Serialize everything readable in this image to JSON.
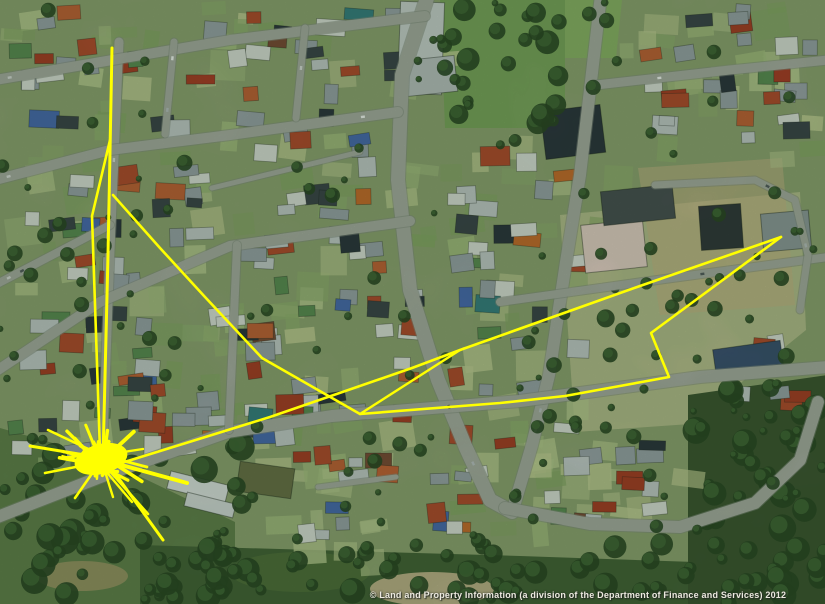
{
  "map": {
    "copyright": "© Land and Property Information (a division of the Department of Finance and Services) 2012",
    "canvas": {
      "width": 825,
      "height": 604
    },
    "colors": {
      "track": "#ffff00",
      "ground": "#8fa073",
      "road": "#a7aaa2",
      "road_casing": "#858a82"
    },
    "regions": [
      {
        "type": "poly",
        "pts": [
          [
            440,
            0
          ],
          [
            565,
            0
          ],
          [
            565,
            128
          ],
          [
            445,
            128
          ]
        ],
        "fill": "#7ba25e",
        "op": 0.95
      },
      {
        "type": "poly",
        "pts": [
          [
            565,
            0
          ],
          [
            622,
            0
          ],
          [
            616,
            58
          ],
          [
            565,
            58
          ]
        ],
        "fill": "#8cb168",
        "op": 0.95
      },
      {
        "type": "poly",
        "pts": [
          [
            560,
            215
          ],
          [
            800,
            192
          ],
          [
            806,
            330
          ],
          [
            690,
            424
          ],
          [
            575,
            432
          ]
        ],
        "fill": "#b7bc8e",
        "op": 0.95
      },
      {
        "type": "poly",
        "pts": [
          [
            638,
            168
          ],
          [
            782,
            158
          ],
          [
            795,
            305
          ],
          [
            660,
            315
          ]
        ],
        "fill": "#c6b086",
        "op": 0.55
      },
      {
        "type": "poly",
        "pts": [
          [
            0,
            428
          ],
          [
            95,
            455
          ],
          [
            235,
            522
          ],
          [
            235,
            604
          ],
          [
            0,
            604
          ]
        ],
        "fill": "#647f4e",
        "op": 1
      },
      {
        "type": "poly",
        "pts": [
          [
            140,
            545
          ],
          [
            520,
            556
          ],
          [
            695,
            562
          ],
          [
            695,
            604
          ],
          [
            140,
            604
          ]
        ],
        "fill": "#46603a",
        "op": 1
      },
      {
        "type": "poly",
        "pts": [
          [
            688,
            395
          ],
          [
            828,
            375
          ],
          [
            828,
            604
          ],
          [
            688,
            604
          ]
        ],
        "fill": "#3e5433",
        "op": 1
      },
      {
        "type": "ellipse",
        "cx": 432,
        "cy": 589,
        "rx": 62,
        "ry": 17,
        "fill": "#c9b894",
        "op": 0.9
      },
      {
        "type": "ellipse",
        "cx": 82,
        "cy": 576,
        "rx": 46,
        "ry": 15,
        "fill": "#b79e74",
        "op": 0.6
      },
      {
        "type": "ellipse",
        "cx": 300,
        "cy": 572,
        "rx": 70,
        "ry": 20,
        "fill": "#55703f",
        "op": 0.8
      }
    ],
    "yard_zones": [
      {
        "x": 0,
        "y": 0,
        "w": 430,
        "h": 470,
        "n": 90
      },
      {
        "x": 440,
        "y": 120,
        "w": 165,
        "h": 350,
        "n": 28
      },
      {
        "x": 610,
        "y": 0,
        "w": 215,
        "h": 155,
        "n": 22
      },
      {
        "x": 235,
        "y": 430,
        "w": 290,
        "h": 120,
        "n": 18
      },
      {
        "x": 520,
        "y": 430,
        "w": 170,
        "h": 110,
        "n": 14
      }
    ],
    "yard_palette": [
      "#a6bb82",
      "#b9c792",
      "#93ad72",
      "#c3cb97",
      "#88a468"
    ],
    "house_zones": [
      {
        "x": 4,
        "y": 4,
        "w": 424,
        "h": 462,
        "n": 150
      },
      {
        "x": 444,
        "y": 118,
        "w": 152,
        "h": 348,
        "n": 30
      },
      {
        "x": 612,
        "y": 4,
        "w": 210,
        "h": 148,
        "n": 26
      },
      {
        "x": 238,
        "y": 428,
        "w": 282,
        "h": 122,
        "n": 20
      },
      {
        "x": 522,
        "y": 430,
        "w": 165,
        "h": 108,
        "n": 14
      },
      {
        "x": 700,
        "y": 330,
        "w": 120,
        "h": 90,
        "n": 6
      }
    ],
    "house_palette": [
      "#9aa1a8",
      "#9aa1a8",
      "#9aa1a8",
      "#9aa1a8",
      "#9aa1a8",
      "#d9dbd6",
      "#d9dbd6",
      "#d9dbd6",
      "#d9dbd6",
      "#c2c7c9",
      "#c2c7c9",
      "#c2c7c9",
      "#a73b28",
      "#a73b28",
      "#b14a30",
      "#b14a30",
      "#c06038",
      "#3d434c",
      "#3d434c",
      "#2e3440",
      "#5d8a56",
      "#5d8a56",
      "#3a7d82",
      "#4a69b0",
      "#7a4a38",
      "#c56a2e"
    ],
    "landmarks": [
      {
        "x": 399,
        "y": 2,
        "w": 44,
        "h": 92,
        "fill": "#c9cdcd",
        "rot": 2
      },
      {
        "x": 404,
        "y": 58,
        "w": 52,
        "h": 36,
        "fill": "#b9bec0",
        "rot": -6
      },
      {
        "x": 543,
        "y": 108,
        "w": 60,
        "h": 48,
        "fill": "#2e3440",
        "rot": -7
      },
      {
        "x": 583,
        "y": 222,
        "w": 62,
        "h": 48,
        "fill": "#e3cdc6",
        "rot": -6
      },
      {
        "x": 602,
        "y": 188,
        "w": 72,
        "h": 34,
        "fill": "#4a4e54",
        "rot": -6
      },
      {
        "x": 700,
        "y": 205,
        "w": 42,
        "h": 44,
        "fill": "#33373d",
        "rot": -4
      },
      {
        "x": 762,
        "y": 212,
        "w": 48,
        "h": 38,
        "fill": "#8e979c",
        "rot": -5
      },
      {
        "x": 714,
        "y": 345,
        "w": 68,
        "h": 24,
        "fill": "#3c4f72",
        "rot": -8
      },
      {
        "x": 168,
        "y": 478,
        "w": 60,
        "h": 18,
        "fill": "#dcdfdf",
        "rot": 14
      },
      {
        "x": 185,
        "y": 498,
        "w": 50,
        "h": 14,
        "fill": "#d2d6d6",
        "rot": 14
      },
      {
        "x": 238,
        "y": 465,
        "w": 55,
        "h": 30,
        "fill": "#6b6f4a",
        "rot": 8
      }
    ],
    "tree_zones": [
      {
        "x": 0,
        "y": 438,
        "w": 245,
        "h": 164,
        "n": 42,
        "rMin": 5,
        "rMax": 14
      },
      {
        "x": 140,
        "y": 540,
        "w": 560,
        "h": 62,
        "n": 55,
        "rMin": 5,
        "rMax": 13
      },
      {
        "x": 682,
        "y": 385,
        "w": 143,
        "h": 219,
        "n": 48,
        "rMin": 5,
        "rMax": 14
      },
      {
        "x": 444,
        "y": 0,
        "w": 118,
        "h": 132,
        "n": 24,
        "rMin": 5,
        "rMax": 12
      },
      {
        "x": 560,
        "y": 200,
        "w": 265,
        "h": 228,
        "n": 16,
        "rMin": 4,
        "rMax": 9
      },
      {
        "x": 0,
        "y": 0,
        "w": 825,
        "h": 545,
        "n": 130,
        "rMin": 3,
        "rMax": 8
      }
    ],
    "tree_colors": [
      "#2c4527",
      "#44663a"
    ],
    "roads": [
      {
        "w": 14,
        "pts": [
          [
            428,
            -5
          ],
          [
            402,
            75
          ],
          [
            398,
            180
          ],
          [
            410,
            290
          ],
          [
            438,
            380
          ],
          [
            466,
            448
          ],
          [
            490,
            500
          ],
          [
            512,
            512
          ]
        ]
      },
      {
        "w": 12,
        "pts": [
          [
            601,
            -5
          ],
          [
            590,
            90
          ],
          [
            580,
            175
          ],
          [
            566,
            262
          ],
          [
            549,
            375
          ],
          [
            532,
            445
          ],
          [
            514,
            506
          ]
        ]
      },
      {
        "w": 12,
        "pts": [
          [
            505,
            508
          ],
          [
            590,
            524
          ],
          [
            680,
            527
          ],
          [
            755,
            503
          ],
          [
            800,
            460
          ],
          [
            818,
            402
          ]
        ]
      },
      {
        "w": 12,
        "pts": [
          [
            -5,
            518
          ],
          [
            108,
            474
          ],
          [
            228,
            432
          ],
          [
            332,
            416
          ],
          [
            520,
            401
          ],
          [
            700,
            377
          ],
          [
            828,
            367
          ]
        ]
      },
      {
        "w": 9,
        "pts": [
          [
            119,
            42
          ],
          [
            110,
            250
          ],
          [
            102,
            466
          ]
        ]
      },
      {
        "w": 10,
        "pts": [
          [
            -5,
            80
          ],
          [
            230,
            40
          ],
          [
            425,
            16
          ]
        ]
      },
      {
        "w": 10,
        "pts": [
          [
            -5,
            180
          ],
          [
            110,
            150
          ],
          [
            230,
            135
          ],
          [
            398,
            112
          ]
        ]
      },
      {
        "w": 8,
        "pts": [
          [
            -5,
            285
          ],
          [
            110,
            225
          ]
        ]
      },
      {
        "w": 10,
        "pts": [
          [
            -5,
            372
          ],
          [
            100,
            302
          ],
          [
            230,
            246
          ],
          [
            410,
            221
          ]
        ]
      },
      {
        "w": 8,
        "pts": [
          [
            500,
            302
          ],
          [
            650,
            281
          ],
          [
            828,
            257
          ]
        ]
      },
      {
        "w": 9,
        "pts": [
          [
            596,
            85
          ],
          [
            730,
            70
          ],
          [
            828,
            60
          ]
        ]
      },
      {
        "w": 7,
        "pts": [
          [
            174,
            42
          ],
          [
            165,
            134
          ]
        ]
      },
      {
        "w": 7,
        "pts": [
          [
            305,
            28
          ],
          [
            296,
            118
          ]
        ]
      },
      {
        "w": 8,
        "pts": [
          [
            237,
            245
          ],
          [
            229,
            430
          ]
        ]
      },
      {
        "w": 7,
        "pts": [
          [
            655,
            185
          ],
          [
            755,
            180
          ],
          [
            795,
            200
          ],
          [
            808,
            255
          ],
          [
            800,
            310
          ]
        ]
      },
      {
        "w": 5,
        "pts": [
          [
            212,
            188
          ],
          [
            360,
            152
          ]
        ]
      },
      {
        "w": 5,
        "pts": [
          [
            318,
            487
          ],
          [
            396,
            477
          ]
        ]
      }
    ],
    "tracks": [
      {
        "w": 3.0,
        "pts": [
          [
            112,
            48
          ],
          [
            108,
            255
          ],
          [
            103,
            458
          ]
        ]
      },
      {
        "w": 2.6,
        "pts": [
          [
            110,
            140
          ],
          [
            92,
            216
          ],
          [
            100,
            452
          ]
        ]
      },
      {
        "w": 2.6,
        "pts": [
          [
            113,
            195
          ],
          [
            160,
            248
          ],
          [
            205,
            297
          ],
          [
            262,
            358
          ],
          [
            360,
            414
          ],
          [
            500,
            403
          ],
          [
            565,
            396
          ],
          [
            669,
            377
          ],
          [
            651,
            333
          ],
          [
            781,
            237
          ]
        ]
      },
      {
        "w": 2.6,
        "pts": [
          [
            781,
            237
          ],
          [
            640,
            286
          ],
          [
            460,
            350
          ],
          [
            412,
            368
          ],
          [
            270,
            417
          ],
          [
            118,
            464
          ]
        ]
      },
      {
        "w": 2.4,
        "pts": [
          [
            460,
            350
          ],
          [
            360,
            414
          ]
        ]
      },
      {
        "w": 3.0,
        "pts": [
          [
            104,
            458
          ],
          [
            163,
            540
          ]
        ]
      },
      {
        "w": 2.6,
        "pts": [
          [
            100,
            460
          ],
          [
            148,
            514
          ]
        ]
      },
      {
        "w": 2.4,
        "pts": [
          [
            98,
            462
          ],
          [
            132,
            502
          ]
        ]
      },
      {
        "w": 4.0,
        "pts": [
          [
            103,
            460
          ],
          [
            187,
            483
          ]
        ]
      },
      {
        "w": 3.0,
        "pts": [
          [
            103,
            458
          ],
          [
            30,
            446
          ]
        ]
      },
      {
        "w": 2.6,
        "pts": [
          [
            101,
            462
          ],
          [
            45,
            473
          ]
        ]
      },
      {
        "w": 2.6,
        "pts": [
          [
            103,
            456
          ],
          [
            48,
            430
          ]
        ]
      },
      {
        "w": 2.6,
        "pts": [
          [
            100,
            462
          ],
          [
            75,
            498
          ]
        ]
      },
      {
        "w": 2.4,
        "pts": [
          [
            102,
            462
          ],
          [
            113,
            497
          ]
        ]
      },
      {
        "w": 2.4,
        "pts": [
          [
            104,
            455
          ],
          [
            143,
            449
          ]
        ]
      }
    ],
    "starburst": {
      "cx": 101,
      "cy": 459,
      "seed": 77,
      "spikes": 26,
      "rMin": 12,
      "rMax": 46,
      "scribbles": 16,
      "scribbleR": 30,
      "coreRx": 27,
      "coreRy": 15,
      "coreRot": -15
    },
    "seed": 1234
  }
}
